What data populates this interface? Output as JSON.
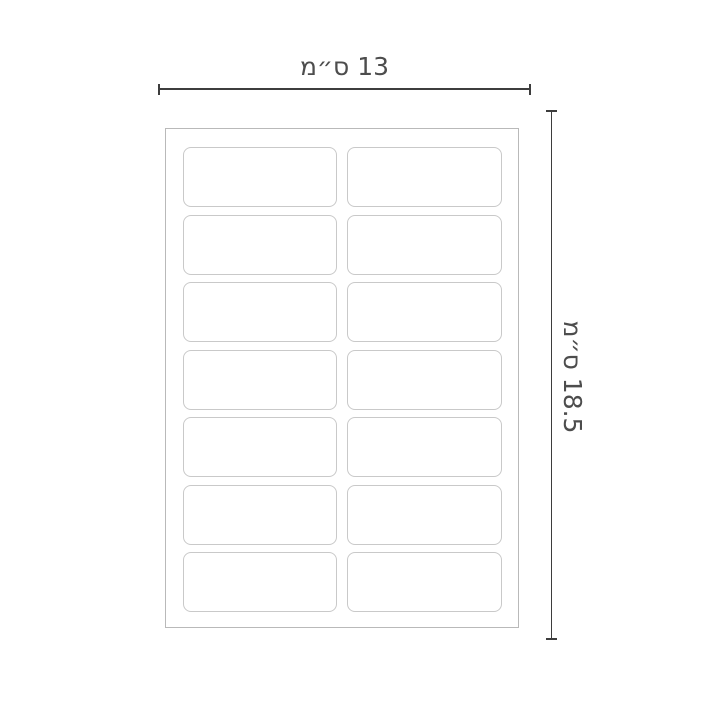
{
  "diagram": {
    "title": "label-sheet-dimension-diagram",
    "dimensions": {
      "width": {
        "label": "13 ס״מ",
        "value": "13",
        "unit": "ס״מ"
      },
      "height": {
        "label": "18.5 ס״מ",
        "value": "18.5",
        "unit": "ס״מ"
      }
    },
    "sheet": {
      "rows": 7,
      "columns": 2,
      "label_count": 14
    },
    "colors": {
      "background": "#ffffff",
      "dimension_line": "#3d3d3d",
      "dimension_text": "#4d4d4d",
      "sheet_border": "#b9b9b9",
      "label_border": "#c9c9c9"
    }
  }
}
